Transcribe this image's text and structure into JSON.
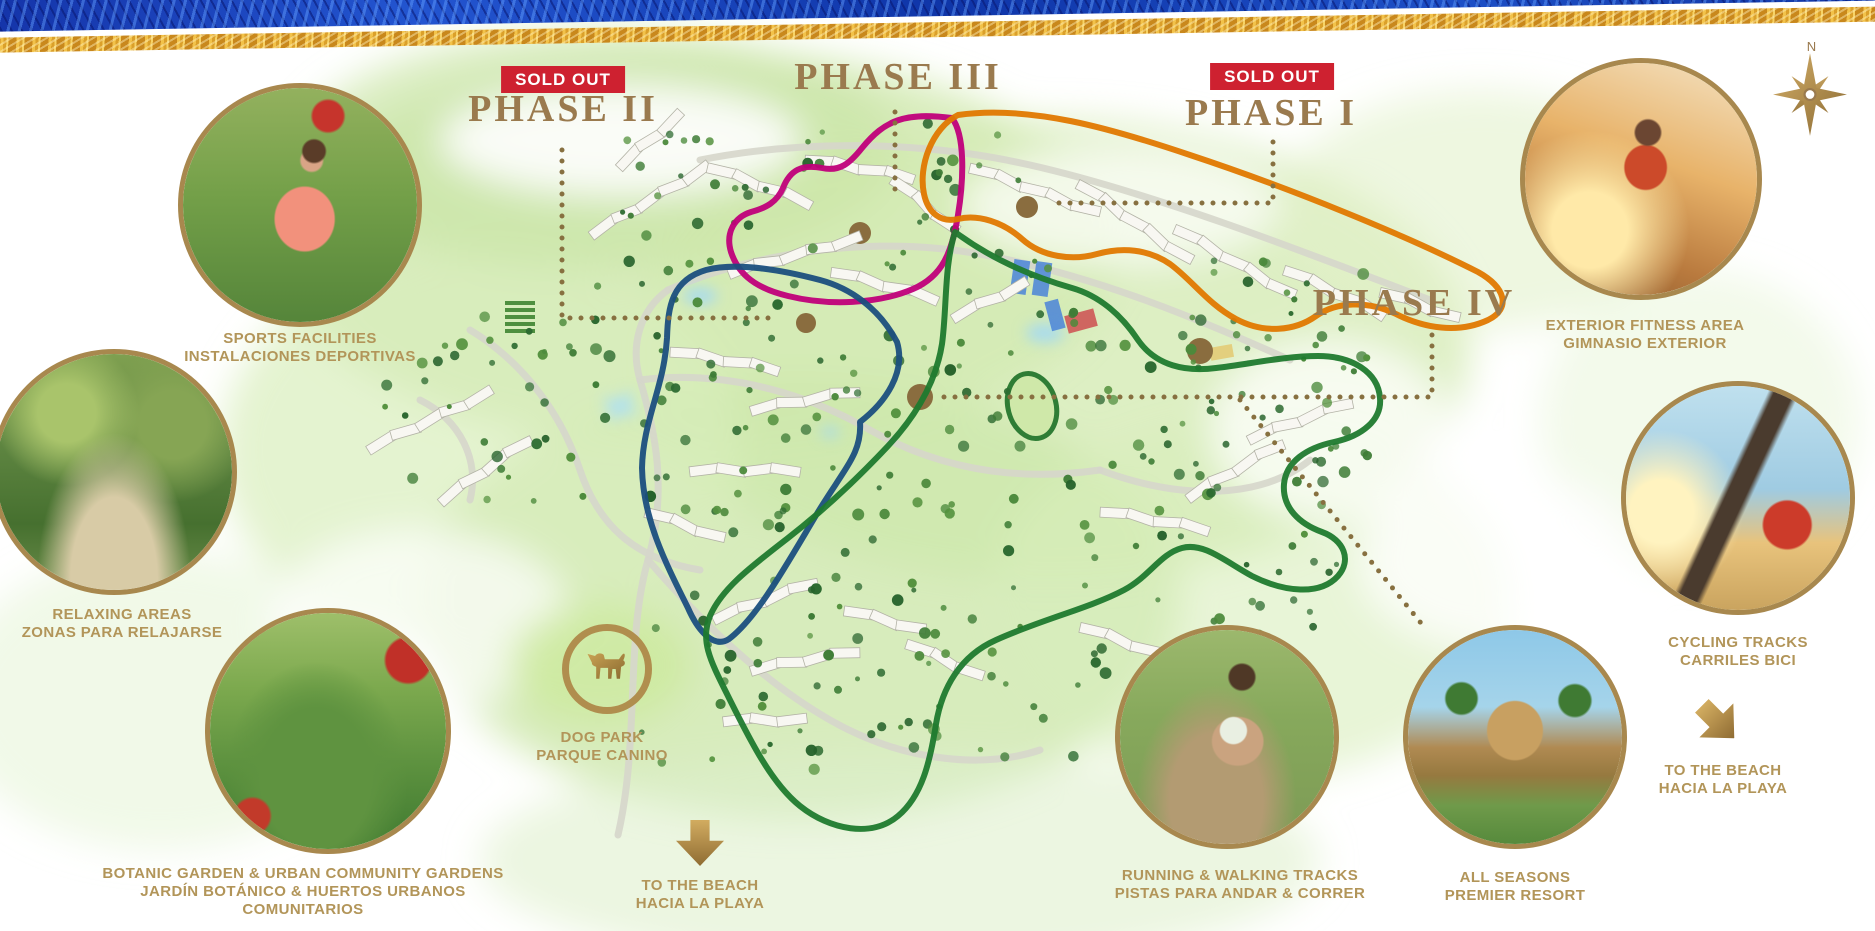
{
  "sold_out_label": "SOLD OUT",
  "phases": [
    {
      "id": "phase-1",
      "label": "PHASE I",
      "sold_out": true,
      "outline_color": "#e07800"
    },
    {
      "id": "phase-2",
      "label": "PHASE II",
      "sold_out": true,
      "outline_color": "#1b4f7e"
    },
    {
      "id": "phase-3",
      "label": "PHASE III",
      "sold_out": false,
      "outline_color": "#c0007a"
    },
    {
      "id": "phase-4",
      "label": "PHASE IV",
      "sold_out": false,
      "outline_color": "#1f7a2e"
    }
  ],
  "features": [
    {
      "id": "sports",
      "lines": [
        "SPORTS FACILITIES",
        "INSTALACIONES DEPORTIVAS"
      ]
    },
    {
      "id": "relaxing",
      "lines": [
        "RELAXING AREAS",
        "ZONAS PARA RELAJARSE"
      ]
    },
    {
      "id": "botanic",
      "lines": [
        "BOTANIC GARDEN & URBAN COMMUNITY GARDENS",
        "JARDÍN BOTÁNICO & HUERTOS URBANOS",
        "COMUNITARIOS"
      ]
    },
    {
      "id": "dog-park",
      "lines": [
        "DOG PARK",
        "PARQUE CANINO"
      ]
    },
    {
      "id": "beach-center",
      "lines": [
        "TO THE BEACH",
        "HACIA LA PLAYA"
      ]
    },
    {
      "id": "fitness",
      "lines": [
        "EXTERIOR FITNESS AREA",
        "GIMNASIO EXTERIOR"
      ]
    },
    {
      "id": "cycling",
      "lines": [
        "CYCLING TRACKS",
        "CARRILES BICI"
      ]
    },
    {
      "id": "beach-right",
      "lines": [
        "TO THE BEACH",
        "HACIA LA PLAYA"
      ]
    },
    {
      "id": "running",
      "lines": [
        "RUNNING & WALKING TRACKS",
        "PISTAS PARA ANDAR & CORRER"
      ]
    },
    {
      "id": "resort",
      "lines": [
        "ALL SEASONS",
        "PREMIER RESORT"
      ]
    }
  ],
  "compass": {
    "north_label": "N"
  },
  "colors": {
    "phase_label_text": "#9a7a4e",
    "caption_text": "#b29559",
    "badge_bg": "#ce2130",
    "badge_text": "#ffffff",
    "dotted_line": "#877040",
    "circle_border_gold": "#a8884e",
    "border_blue": "#1a3fb0",
    "border_gold": "#e0a82e",
    "map_wash_green": "#d4ebb4"
  }
}
